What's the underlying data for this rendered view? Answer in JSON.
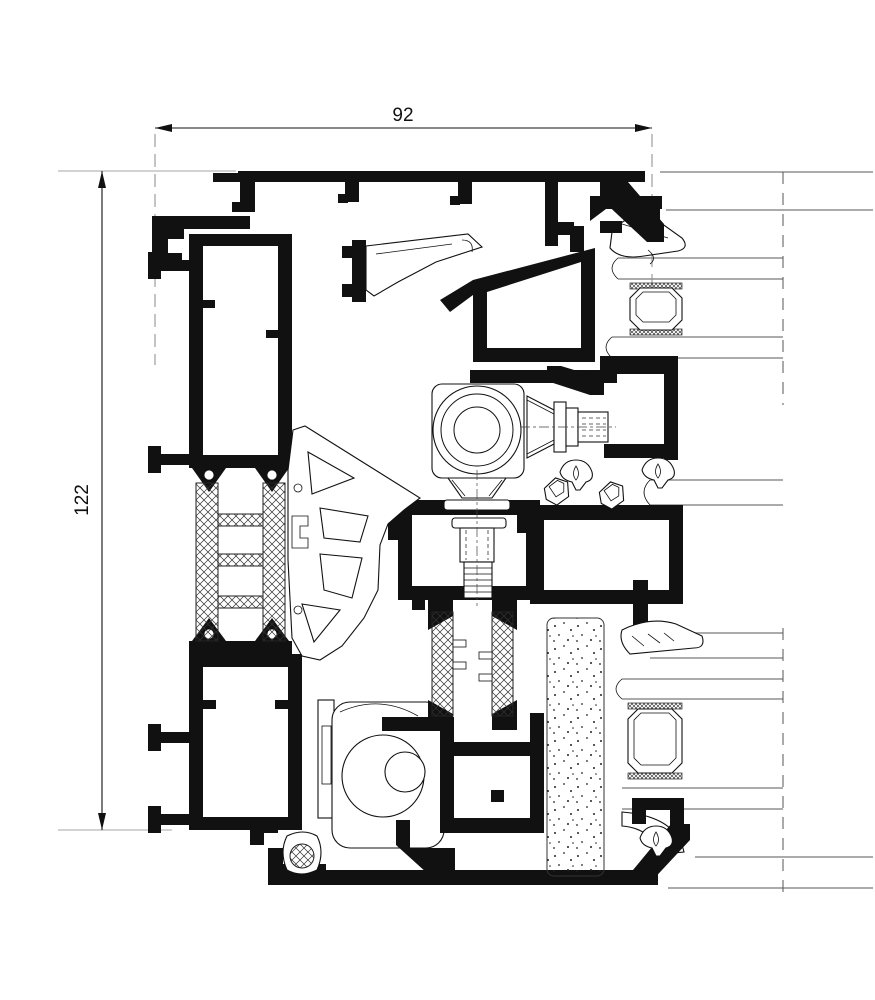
{
  "drawing": {
    "width_dimension": {
      "value": "92"
    },
    "height_dimension": {
      "value": "122"
    }
  },
  "style": {
    "background": "#ffffff",
    "line_color": "#111111",
    "glass_line_color": "#8f8f8f",
    "extension_line_color": "#a6a6a6"
  }
}
